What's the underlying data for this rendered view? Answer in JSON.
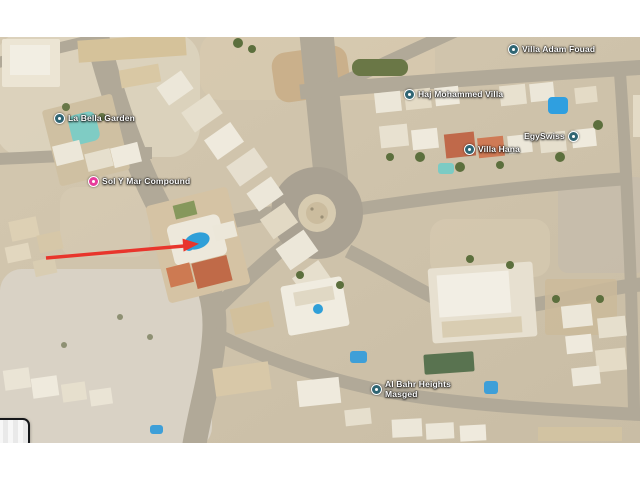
{
  "map": {
    "description": "Satellite imagery of a desert residential district with a central roundabout",
    "colors": {
      "sand": "#cfc3ab",
      "road": "#b1a998",
      "arrow_red": "#e8352c",
      "pool_blue": "#2f9fd8",
      "label_text": "#ffffff",
      "poi_icon_teal": "#2f6573",
      "poi_icon_pink": "#e63c9b"
    },
    "labels": [
      {
        "text": "La Bella Garden"
      },
      {
        "text": "Sol Y Mar Compound"
      },
      {
        "text": "Haj Mohammed Villa"
      },
      {
        "text": "Villa Adam Fouad"
      },
      {
        "text": "EgySwiss"
      },
      {
        "text": "Villa Hana"
      },
      {
        "text_line1": "Al Bahr Heights",
        "text_line2": "Masged"
      }
    ],
    "annotation": {
      "type": "red-arrow",
      "target": "swimming pool inside Sol Y Mar Compound"
    }
  }
}
